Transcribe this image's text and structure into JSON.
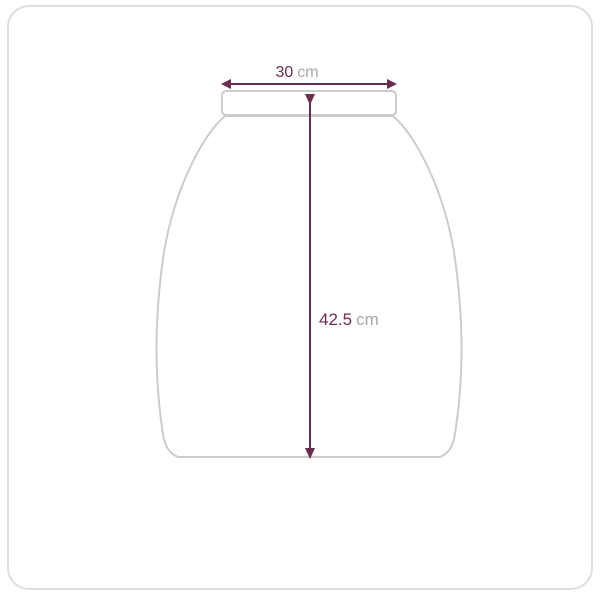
{
  "diagram": {
    "title": "garment dimension diagram",
    "width_measure": {
      "value": "30",
      "unit": "cm"
    },
    "height_measure": {
      "value": "42.5",
      "unit": "cm"
    },
    "colors": {
      "measure": "#692d4e",
      "value_text": "#6d2c4f",
      "unit_text": "#a8a8a8",
      "outline": "#cccccc",
      "card_border": "#dedede",
      "background": "#ffffff"
    }
  }
}
